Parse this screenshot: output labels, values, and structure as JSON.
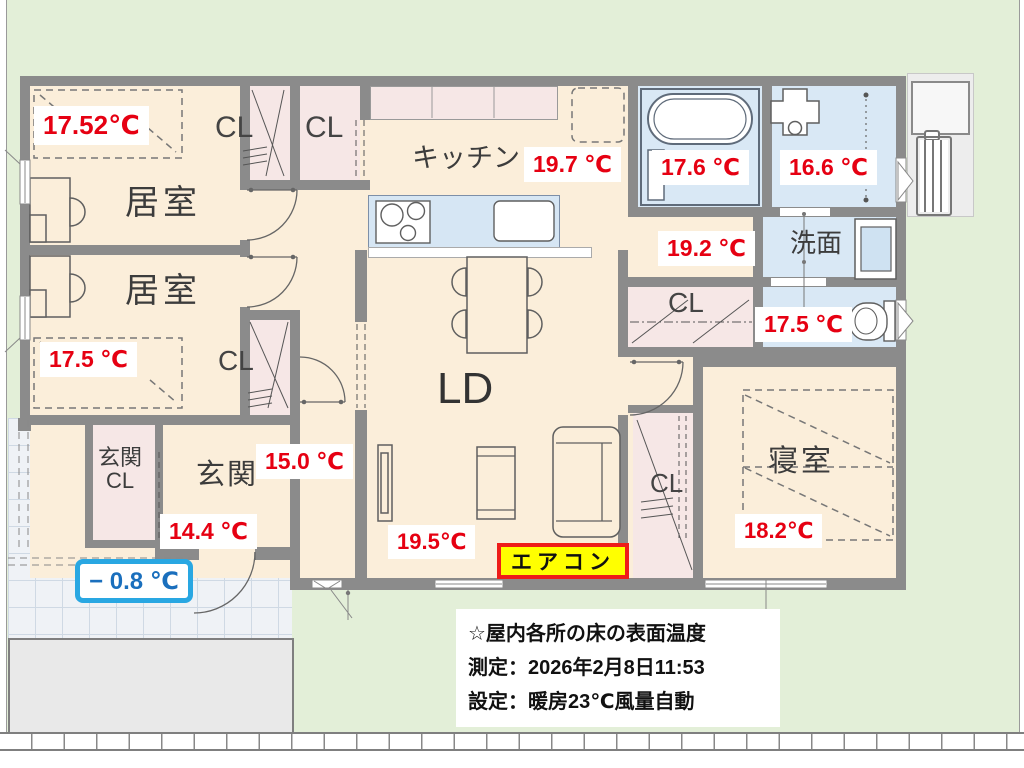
{
  "title": "間取り図（床の表面温度測定）",
  "colors": {
    "yard_green": "#e3efd8",
    "floor_cream": "#fbeeda",
    "closet_pink": "#f6e7e6",
    "wet_area_blue": "#d9e8f5",
    "entrance_tile": "#eff2f6",
    "wall_gray": "#8b8b8b",
    "temp_red": "#e60012",
    "outdoor_box_border": "#29a7e2",
    "outdoor_text_blue": "#1a6fbd",
    "aircon_bg": "#ffff00",
    "aircon_border": "#ee1c19"
  },
  "labels": {
    "room1": "居室",
    "room2": "居室",
    "cl_top_a": "CL",
    "cl_top_b": "CL",
    "cl_mid": "CL",
    "kitchen": "キッチン",
    "ld": "LD",
    "washroom": "洗面",
    "cl_hall": "CL",
    "bedroom": "寝室",
    "cl_bedroom": "CL",
    "genkan": "玄関",
    "genkan_cl_line1": "玄関",
    "genkan_cl_line2": "CL"
  },
  "temps": {
    "room1": "17.52℃",
    "room2": "17.5 ℃",
    "kitchen": "19.7 ℃",
    "bath": "17.6 ℃",
    "laundry": "16.6 ℃",
    "hall_sanitary": "19.2 ℃",
    "toilet": "17.5 ℃",
    "bedroom": "18.2℃",
    "ld": "19.5℃",
    "hall": "15.0 ℃",
    "genkan": "14.4 ℃",
    "outdoor": "− 0.8 ℃"
  },
  "aircon": {
    "label": "エアコン"
  },
  "notes": {
    "line1": "☆屋内各所の床の表面温度",
    "line2": "測定：2026年2月8日11:53",
    "line3": "設定：暖房23℃風量自動"
  }
}
